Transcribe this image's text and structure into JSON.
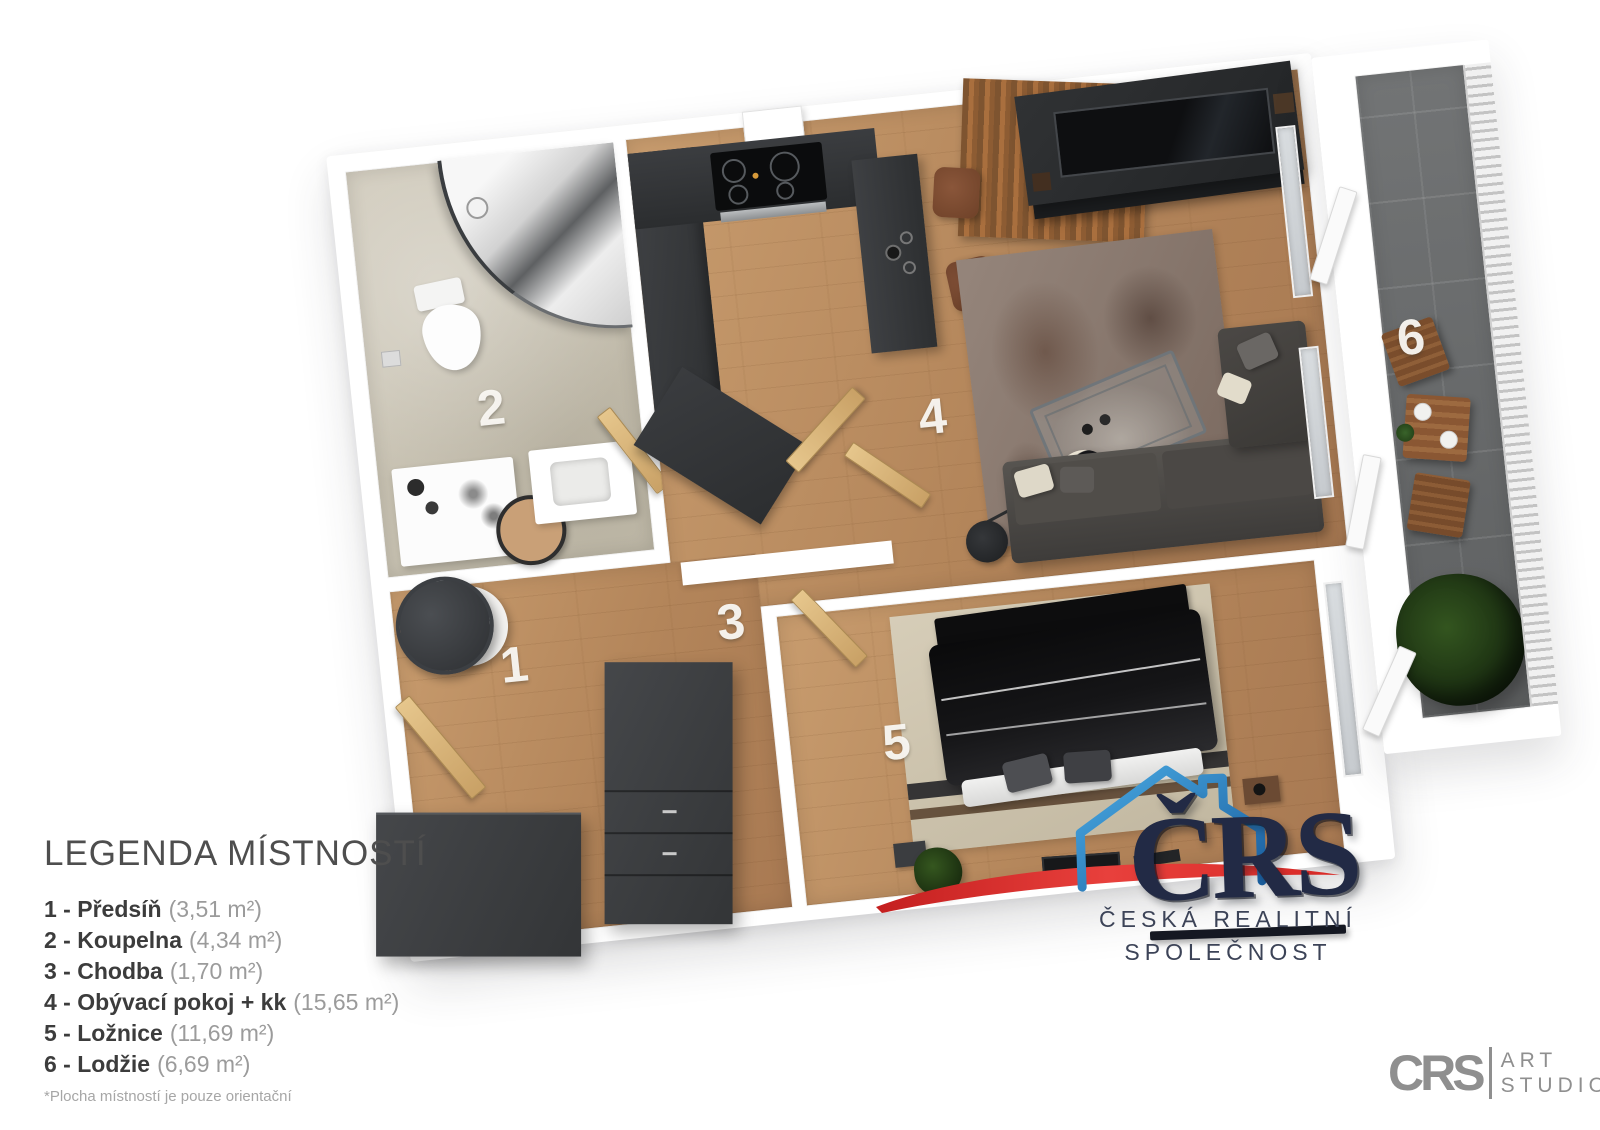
{
  "legend": {
    "title": "LEGENDA MÍSTNOSTÍ",
    "items": [
      {
        "num": "1",
        "name": "1 - Předsíň",
        "area": "(3,51 m²)"
      },
      {
        "num": "2",
        "name": "2 - Koupelna",
        "area": "(4,34 m²)"
      },
      {
        "num": "3",
        "name": "3 - Chodba",
        "area": "(1,70 m²)"
      },
      {
        "num": "4",
        "name": "4 - Obývací pokoj + kk",
        "area": "(15,65 m²)"
      },
      {
        "num": "5",
        "name": "5 - Ložnice",
        "area": "(11,69 m²)"
      },
      {
        "num": "6",
        "name": "6 - Lodžie",
        "area": "(6,69 m²)"
      }
    ],
    "footnote": "*Plocha místností je pouze orientační"
  },
  "branding": {
    "letters": "ČRS",
    "line1": "ČESKÁ REALITNÍ",
    "line2": "SPOLEČNOST",
    "colors": {
      "navy": "#222a45",
      "house_blue": "#2f8fd0",
      "swoosh_red": "#df312e"
    }
  },
  "studio": {
    "mark": "CRS",
    "line1": "ART",
    "line2": "STUDIO"
  },
  "palette": {
    "wood_floor": "#bd9164",
    "bath_tile": "#c9c3b4",
    "loggia_tile": "#6f7173",
    "kitchen_dark": "#3a3c3e"
  }
}
